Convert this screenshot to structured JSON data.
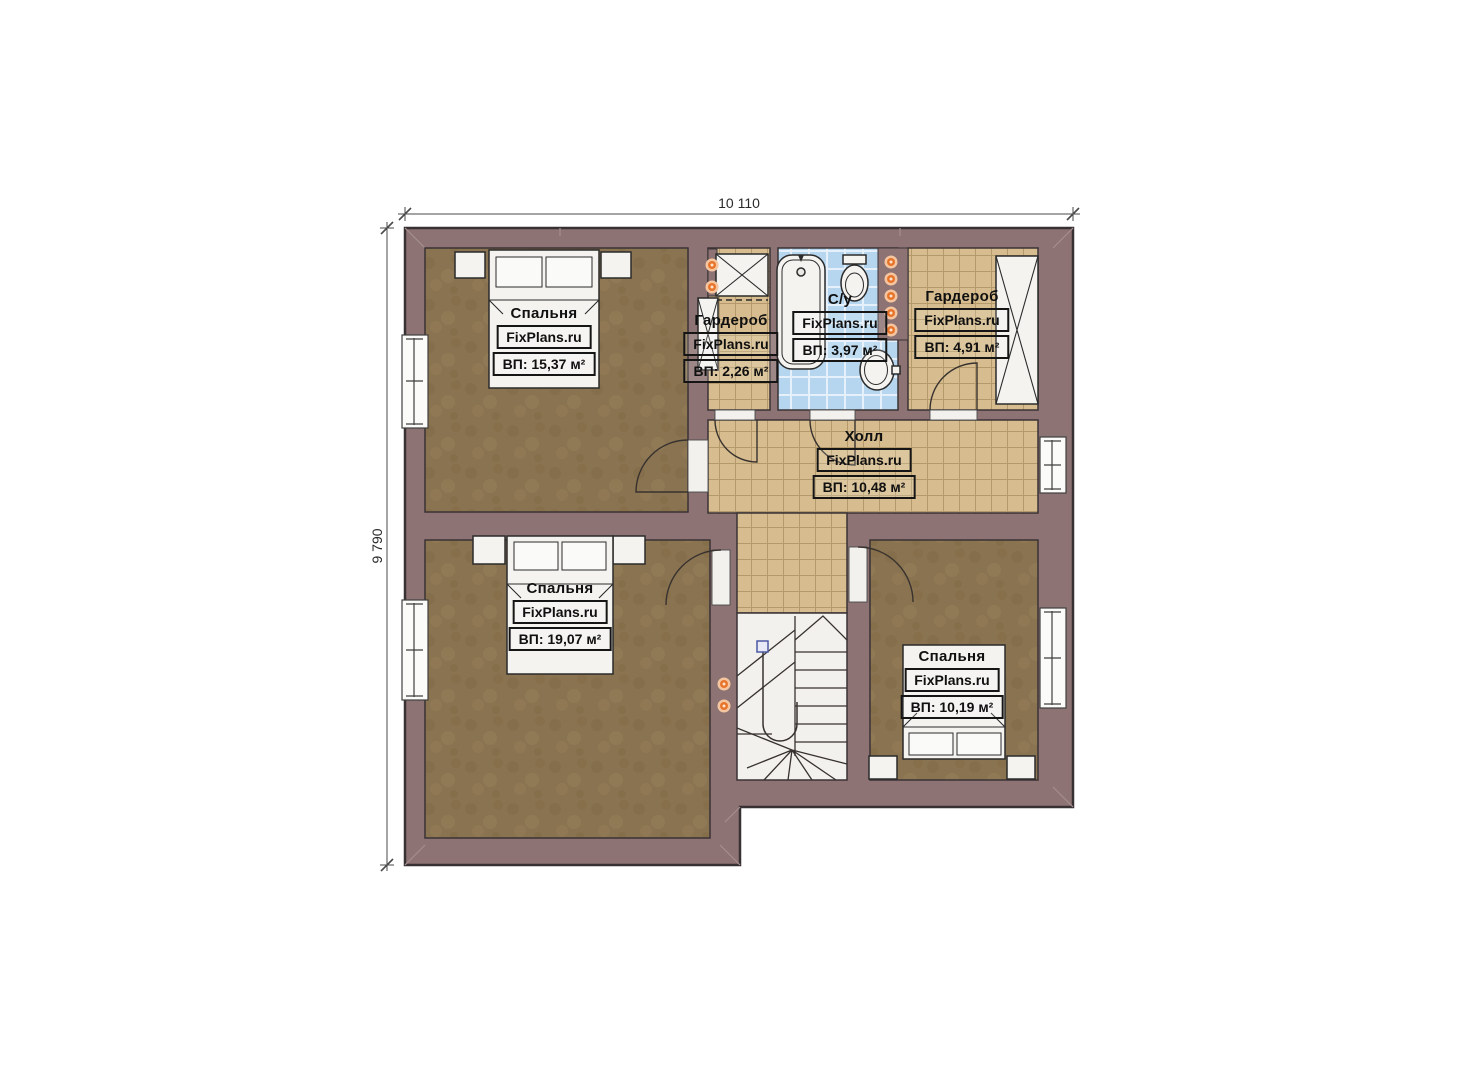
{
  "plan": {
    "watermark": "FixPlans.ru",
    "dimensions": {
      "width_label": "10 110",
      "height_label": "9 790"
    },
    "rooms": [
      {
        "id": "bedroom-top-left",
        "name": "Спальня",
        "area": "ВП: 15,37 м²"
      },
      {
        "id": "wardrobe-left",
        "name": "Гардероб",
        "area": "ВП: 2,26 м²"
      },
      {
        "id": "bathroom",
        "name": "С/у",
        "area": "ВП: 3,97 м²"
      },
      {
        "id": "wardrobe-right",
        "name": "Гардероб",
        "area": "ВП: 4,91 м²"
      },
      {
        "id": "hall",
        "name": "Холл",
        "area": "ВП: 10,48 м²"
      },
      {
        "id": "bedroom-bottom-left",
        "name": "Спальня",
        "area": "ВП: 19,07 м²"
      },
      {
        "id": "bedroom-bottom-right",
        "name": "Спальня",
        "area": "ВП: 10,19 м²"
      }
    ],
    "colors": {
      "wall": "#8d7373",
      "wood_floor": "#8a7350",
      "tile_beige": "#d6bc8e",
      "tile_blue": "#b6d6ef",
      "fixture_white": "#f4f3f0",
      "light_dot": "#e8742b"
    }
  }
}
